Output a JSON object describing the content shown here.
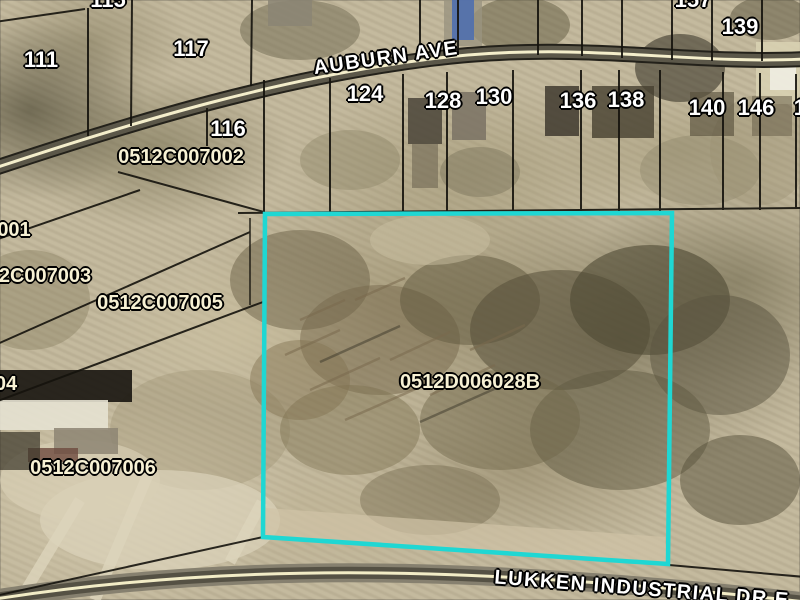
{
  "map": {
    "type": "aerial-parcel-map",
    "highlight_color": "#1fd7d3",
    "selected_parcel_id": "0512D006028B",
    "street_labels": [
      {
        "text": "AUBURN AVE",
        "x": 386,
        "y": 58,
        "rot": -8
      },
      {
        "text": "LUKKEN INDUSTRIAL DR E",
        "x": 642,
        "y": 589,
        "rot": 4.5
      }
    ],
    "parcel_labels": [
      {
        "text": "001",
        "x": 14,
        "y": 230
      },
      {
        "text": "2C007003",
        "x": 45,
        "y": 276
      },
      {
        "text": "0512C007005",
        "x": 160,
        "y": 303
      },
      {
        "text": "04",
        "x": 6,
        "y": 384
      },
      {
        "text": "0512C007006",
        "x": 93,
        "y": 468
      },
      {
        "text": "0512C007002",
        "x": 181,
        "y": 157
      },
      {
        "text": "0512D006028B",
        "x": 470,
        "y": 382
      }
    ],
    "house_numbers": [
      {
        "text": "115",
        "x": 108,
        "y": 0
      },
      {
        "text": "157",
        "x": 693,
        "y": 0
      },
      {
        "text": "111",
        "x": 41,
        "y": 60
      },
      {
        "text": "117",
        "x": 191,
        "y": 49
      },
      {
        "text": "139",
        "x": 740,
        "y": 27
      },
      {
        "text": "116",
        "x": 228,
        "y": 129
      },
      {
        "text": "124",
        "x": 365,
        "y": 94
      },
      {
        "text": "128",
        "x": 443,
        "y": 101
      },
      {
        "text": "130",
        "x": 494,
        "y": 97
      },
      {
        "text": "136",
        "x": 578,
        "y": 101
      },
      {
        "text": "138",
        "x": 626,
        "y": 100
      },
      {
        "text": "140",
        "x": 707,
        "y": 108
      },
      {
        "text": "146",
        "x": 756,
        "y": 108
      },
      {
        "text": "14",
        "x": 806,
        "y": 108
      }
    ]
  }
}
